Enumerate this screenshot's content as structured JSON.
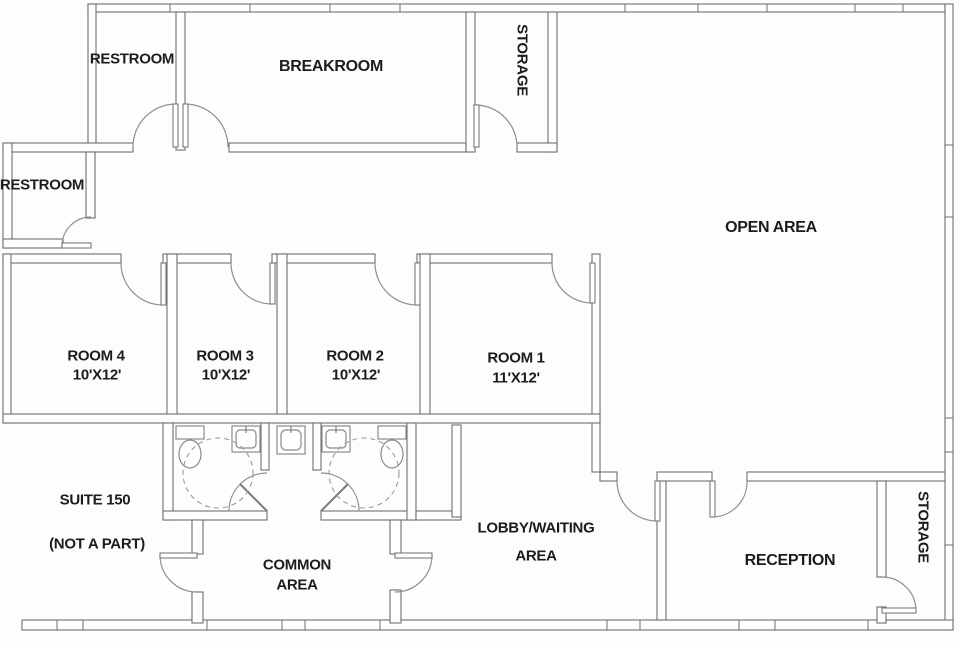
{
  "title": "Office suite floor plan",
  "colors": {
    "wall": "#6e6e6e",
    "door_arc": "#8f8f8f",
    "text": "#1c1c1c",
    "background": "#fdfdfd"
  },
  "fixture_icons": [
    "toilet-icon",
    "sink-icon",
    "drinking-fountain-icon",
    "door-swing-icon",
    "turning-radius-circle-icon",
    "window-tick-icon"
  ],
  "rooms": {
    "restroom_top": {
      "label": "RESTROOM"
    },
    "breakroom": {
      "label": "BREAKROOM"
    },
    "storage_top": {
      "label": "STORAGE"
    },
    "restroom_left": {
      "label": "RESTROOM"
    },
    "open_area": {
      "label": "OPEN AREA"
    },
    "room4": {
      "name": "ROOM 4",
      "size": "10'X12'"
    },
    "room3": {
      "name": "ROOM 3",
      "size": "10'X12'"
    },
    "room2": {
      "name": "ROOM 2",
      "size": "10'X12'"
    },
    "room1": {
      "name": "ROOM 1",
      "size": "11'X12'"
    },
    "suite150": {
      "name": "SUITE 150",
      "note": "(NOT A PART)"
    },
    "common_area": {
      "line1": "COMMON",
      "line2": "AREA"
    },
    "lobby": {
      "line1": "LOBBY/WAITING",
      "line2": "AREA"
    },
    "reception": {
      "label": "RECEPTION"
    },
    "storage_right": {
      "label": "STORAGE"
    }
  }
}
